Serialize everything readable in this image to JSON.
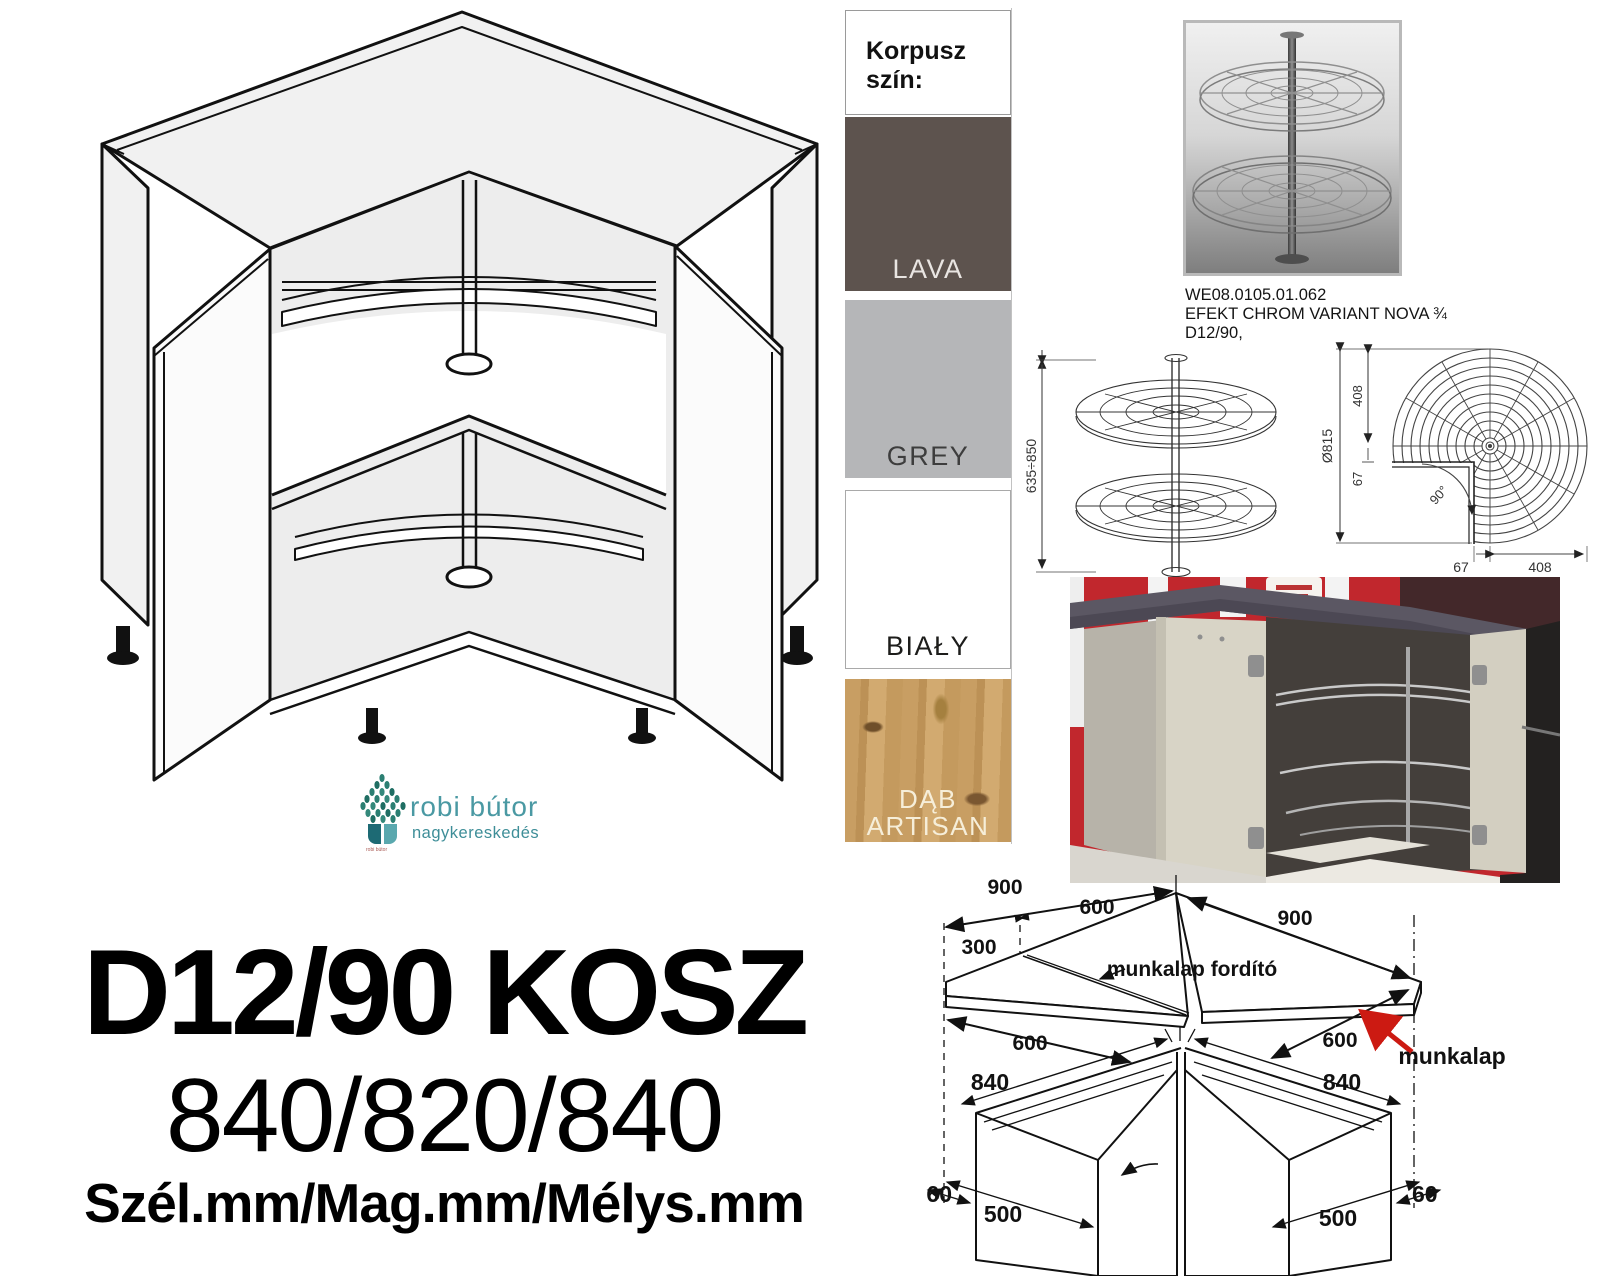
{
  "product": {
    "title": "D12/90 KOSZ",
    "dimensions": "840/820/840",
    "dimensions_legend": "Szél.mm/Mag.mm/Mélys.mm"
  },
  "brand": {
    "name": "robi bútor",
    "subtitle": "nagykereskedés",
    "tiny_mark": "robi bútor",
    "name_color": "#4a99a3",
    "subtitle_color": "#3e8e98",
    "leaf_color": "#2b7f72"
  },
  "korpusz": {
    "header": "Korpusz szín:",
    "swatches": [
      {
        "label": "LAVA",
        "color": "#5d534e",
        "text_color": "#e9e5e2"
      },
      {
        "label": "GREY",
        "color": "#b5b6b8",
        "text_color": "#3d3d3d"
      },
      {
        "label": "BIAŁY",
        "color": "#ffffff",
        "text_color": "#1d1d1b"
      },
      {
        "label": "DĄB ARTISAN",
        "line1": "DĄB",
        "line2": "ARTISAN",
        "color": "#c89e63",
        "text_color": "#f6eed9"
      }
    ]
  },
  "accessory": {
    "code": "WE08.0105.01.062",
    "name": "EFEKT CHROM VARIANT NOVA ¾",
    "model": "D12/90,"
  },
  "carousel_drawing": {
    "height_range": "635÷850"
  },
  "topview_drawing": {
    "diameter": "Ø815",
    "top_radius": "408",
    "offset": "67",
    "angle": "90°",
    "bottom_offset": "67",
    "bottom_radius": "408"
  },
  "plan_drawing": {
    "left_length": "900",
    "left_inner": "600",
    "left_end": "300",
    "left_front": "600",
    "corner_label": "munkalap fordító",
    "right_length": "900",
    "right_front": "600",
    "worktop_label": "munkalap",
    "left_width": "840",
    "right_width": "840",
    "left_gap": "60",
    "right_gap": "60",
    "left_door": "500",
    "right_door": "500",
    "arrow_color": "#cc1a12"
  }
}
